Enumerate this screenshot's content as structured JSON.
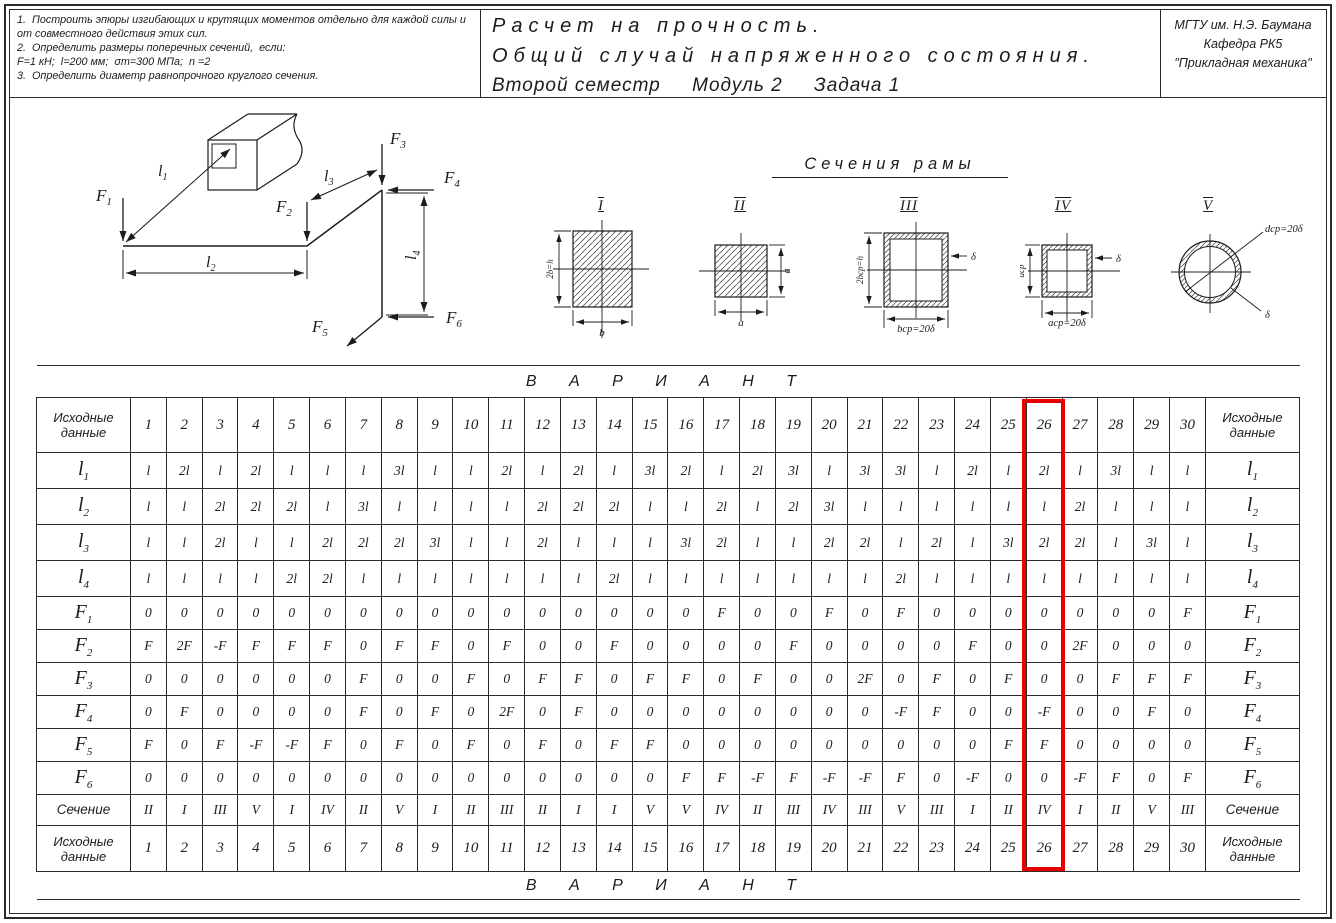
{
  "page": {
    "ink": "#1c1c1c",
    "highlight_red": "#e80000"
  },
  "header": {
    "tasks": [
      "1.  Построить эпюры изгибающих и крутящих моментов отдельно для каждой силы и от совместного действия этих сил.",
      "2.  Определить размеры поперечных сечений,  если:",
      "F=1 кН;  l=200 мм;  σт=300 МПа;  n =2",
      "3.  Определить диаметр равнопрочного круглого сечения."
    ],
    "title_lines": [
      "Расчет на прочность.",
      "Общий случай напряженного состояния.",
      "Второй семестр     Модуль 2     Задача 1"
    ],
    "org_lines": [
      "МГТУ им.  Н.Э.  Баумана",
      "Кафедра РК5",
      "\"Прикладная механика\""
    ]
  },
  "frame": {
    "forces": [
      {
        "b": "F",
        "s": "1"
      },
      {
        "b": "F",
        "s": "2"
      },
      {
        "b": "F",
        "s": "3"
      },
      {
        "b": "F",
        "s": "4"
      },
      {
        "b": "F",
        "s": "5"
      },
      {
        "b": "F",
        "s": "6"
      }
    ],
    "lengths": [
      {
        "b": "l",
        "s": "1"
      },
      {
        "b": "l",
        "s": "2"
      },
      {
        "b": "l",
        "s": "3"
      },
      {
        "b": "l",
        "s": "4"
      }
    ]
  },
  "sections": {
    "title": "Сечения рамы",
    "items": [
      {
        "numeral": "I",
        "dim_left": "2b=h",
        "dim_bottom": "b"
      },
      {
        "numeral": "II",
        "dim_right": "a",
        "dim_bottom": "a"
      },
      {
        "numeral": "III",
        "dim_left": "2bср=h",
        "dim_bottom": "bср=20δ",
        "thickness": "δ"
      },
      {
        "numeral": "IV",
        "dim_left": "aср",
        "dim_bottom": "aср=20δ",
        "thickness": "δ"
      },
      {
        "numeral": "V",
        "diameter": "dср=20δ",
        "thickness": "δ"
      }
    ]
  },
  "table": {
    "variant_header": "В А Р И А Н Т",
    "corner_label": "Исходные данные",
    "columns": [
      "1",
      "2",
      "3",
      "4",
      "5",
      "6",
      "7",
      "8",
      "9",
      "10",
      "11",
      "12",
      "13",
      "14",
      "15",
      "16",
      "17",
      "18",
      "19",
      "20",
      "21",
      "22",
      "23",
      "24",
      "25",
      "26",
      "27",
      "28",
      "29",
      "30"
    ],
    "highlighted_column": "26",
    "rows": [
      {
        "kind": "dim",
        "label": "l",
        "sub": "1",
        "values": [
          "l",
          "2l",
          "l",
          "2l",
          "l",
          "l",
          "l",
          "3l",
          "l",
          "l",
          "2l",
          "l",
          "2l",
          "l",
          "3l",
          "2l",
          "l",
          "2l",
          "3l",
          "l",
          "3l",
          "3l",
          "l",
          "2l",
          "l",
          "2l",
          "l",
          "3l",
          "l",
          "l"
        ]
      },
      {
        "kind": "dim",
        "label": "l",
        "sub": "2",
        "values": [
          "l",
          "l",
          "2l",
          "2l",
          "2l",
          "l",
          "3l",
          "l",
          "l",
          "l",
          "l",
          "2l",
          "2l",
          "2l",
          "l",
          "l",
          "2l",
          "l",
          "2l",
          "3l",
          "l",
          "l",
          "l",
          "l",
          "l",
          "l",
          "2l",
          "l",
          "l",
          "l"
        ]
      },
      {
        "kind": "dim",
        "label": "l",
        "sub": "3",
        "values": [
          "l",
          "l",
          "2l",
          "l",
          "l",
          "2l",
          "2l",
          "2l",
          "3l",
          "l",
          "l",
          "2l",
          "l",
          "l",
          "l",
          "3l",
          "2l",
          "l",
          "l",
          "2l",
          "2l",
          "l",
          "2l",
          "l",
          "3l",
          "2l",
          "2l",
          "l",
          "3l",
          "l"
        ]
      },
      {
        "kind": "dim",
        "label": "l",
        "sub": "4",
        "values": [
          "l",
          "l",
          "l",
          "l",
          "2l",
          "2l",
          "l",
          "l",
          "l",
          "l",
          "l",
          "l",
          "l",
          "2l",
          "l",
          "l",
          "l",
          "l",
          "l",
          "l",
          "l",
          "2l",
          "l",
          "l",
          "l",
          "l",
          "l",
          "l",
          "l",
          "l"
        ]
      },
      {
        "kind": "force",
        "label": "F",
        "sub": "1",
        "values": [
          "0",
          "0",
          "0",
          "0",
          "0",
          "0",
          "0",
          "0",
          "0",
          "0",
          "0",
          "0",
          "0",
          "0",
          "0",
          "0",
          "F",
          "0",
          "0",
          "F",
          "0",
          "F",
          "0",
          "0",
          "0",
          "0",
          "0",
          "0",
          "0",
          "F"
        ]
      },
      {
        "kind": "force",
        "label": "F",
        "sub": "2",
        "values": [
          "F",
          "2F",
          "-F",
          "F",
          "F",
          "F",
          "0",
          "F",
          "F",
          "0",
          "F",
          "0",
          "0",
          "F",
          "0",
          "0",
          "0",
          "0",
          "F",
          "0",
          "0",
          "0",
          "0",
          "F",
          "0",
          "0",
          "2F",
          "0",
          "0",
          "0"
        ]
      },
      {
        "kind": "force",
        "label": "F",
        "sub": "3",
        "values": [
          "0",
          "0",
          "0",
          "0",
          "0",
          "0",
          "F",
          "0",
          "0",
          "F",
          "0",
          "F",
          "F",
          "0",
          "F",
          "F",
          "0",
          "F",
          "0",
          "0",
          "2F",
          "0",
          "F",
          "0",
          "F",
          "0",
          "0",
          "F",
          "F",
          "F"
        ]
      },
      {
        "kind": "force",
        "label": "F",
        "sub": "4",
        "values": [
          "0",
          "F",
          "0",
          "0",
          "0",
          "0",
          "F",
          "0",
          "F",
          "0",
          "2F",
          "0",
          "F",
          "0",
          "0",
          "0",
          "0",
          "0",
          "0",
          "0",
          "0",
          "-F",
          "F",
          "0",
          "0",
          "-F",
          "0",
          "0",
          "F",
          "0"
        ]
      },
      {
        "kind": "force",
        "label": "F",
        "sub": "5",
        "values": [
          "F",
          "0",
          "F",
          "-F",
          "-F",
          "F",
          "0",
          "F",
          "0",
          "F",
          "0",
          "F",
          "0",
          "F",
          "F",
          "0",
          "0",
          "0",
          "0",
          "0",
          "0",
          "0",
          "0",
          "0",
          "F",
          "F",
          "0",
          "0",
          "0",
          "0"
        ]
      },
      {
        "kind": "force",
        "label": "F",
        "sub": "6",
        "values": [
          "0",
          "0",
          "0",
          "0",
          "0",
          "0",
          "0",
          "0",
          "0",
          "0",
          "0",
          "0",
          "0",
          "0",
          "0",
          "F",
          "F",
          "-F",
          "F",
          "-F",
          "-F",
          "F",
          "0",
          "-F",
          "0",
          "0",
          "-F",
          "F",
          "0",
          "F"
        ]
      },
      {
        "kind": "section",
        "label": "Сечение",
        "sub": "",
        "values": [
          "II",
          "I",
          "III",
          "V",
          "I",
          "IV",
          "II",
          "V",
          "I",
          "II",
          "III",
          "II",
          "I",
          "I",
          "V",
          "V",
          "IV",
          "II",
          "III",
          "IV",
          "III",
          "V",
          "III",
          "I",
          "II",
          "IV",
          "I",
          "II",
          "V",
          "III"
        ]
      }
    ]
  }
}
